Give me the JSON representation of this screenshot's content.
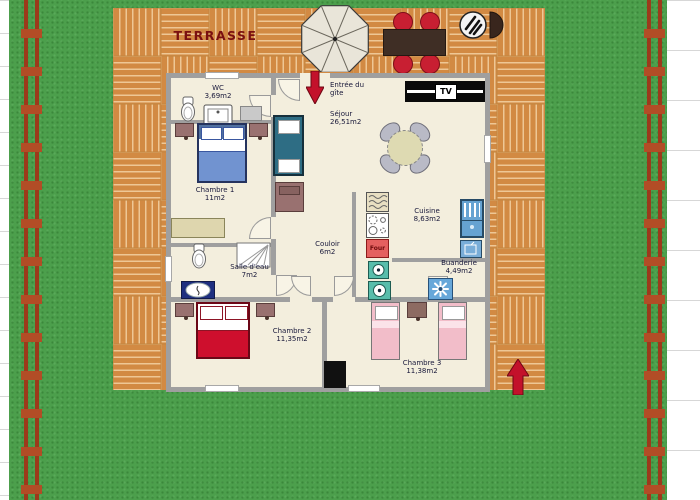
{
  "labels": {
    "terrasse": "TERRASSE",
    "entree": "Entrée du\ngîte",
    "tv": "TV",
    "four": "Four"
  },
  "rooms": {
    "wc": {
      "name": "WC",
      "area": "3,69m2"
    },
    "chambre1": {
      "name": "Chambre 1",
      "area": "11m2"
    },
    "sejour": {
      "name": "Séjour",
      "area": "26,51m2"
    },
    "couloir": {
      "name": "Couloir",
      "area": "6m2"
    },
    "salle_eau": {
      "name": "Salle d'eau",
      "area": "7m2"
    },
    "cuisine": {
      "name": "Cuisine",
      "area": "8,63m2"
    },
    "buanderie": {
      "name": "Buanderie",
      "area": "4,49m2"
    },
    "chambre2": {
      "name": "Chambre 2",
      "area": "11,35m2"
    },
    "chambre3": {
      "name": "Chambre 3",
      "area": "11,38m2"
    }
  },
  "colors": {
    "grass": "#4c9f4c",
    "deck": "#d28a43",
    "deck_line": "#eec795",
    "fence": "#a63c1c",
    "wall": "#9f9f9f",
    "floor": "#f3eedd",
    "accent_red": "#c3112b",
    "terrasse_text": "#7a1010"
  }
}
